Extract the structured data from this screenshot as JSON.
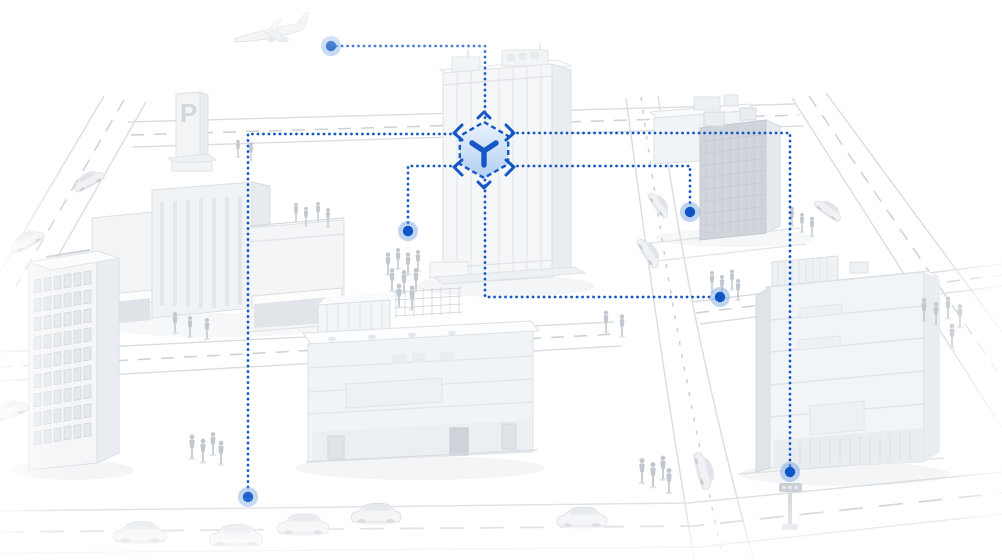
{
  "colors": {
    "accent_blue": "#1356c4",
    "dot_core": "#0d55c5",
    "dot_halo": "#6f9fe0",
    "hex_fill_top": "#e9f2fd",
    "hex_fill_bottom": "#b3cff2",
    "building_gray": "#f2f5f7",
    "road_gray": "#d9dde1"
  },
  "parking_sign": {
    "label": "P"
  },
  "icons": [
    "cube-3d-icon",
    "node-dot-icon",
    "airplane-icon",
    "parking-sign",
    "traffic-light-icon"
  ],
  "network": {
    "hub": {
      "x": 484,
      "y": 150,
      "radius": 28
    },
    "nodes": [
      {
        "id": "node-airplane",
        "x": 331,
        "y": 46
      },
      {
        "id": "node-plaza",
        "x": 408,
        "y": 231
      },
      {
        "id": "node-northeast-block",
        "x": 690,
        "y": 212
      },
      {
        "id": "node-crossing",
        "x": 720,
        "y": 297
      },
      {
        "id": "node-southwest-street",
        "x": 248,
        "y": 497
      },
      {
        "id": "node-southeast-street",
        "x": 790,
        "y": 472
      }
    ],
    "links": [
      {
        "id": "link-airplane",
        "points": [
          [
            331,
            46
          ],
          [
            485,
            46
          ],
          [
            485,
            121
          ]
        ]
      },
      {
        "id": "link-crossing",
        "points": [
          [
            485,
            180
          ],
          [
            485,
            297
          ],
          [
            714,
            297
          ]
        ]
      },
      {
        "id": "link-southwest",
        "points": [
          [
            456,
            134
          ],
          [
            248,
            134
          ],
          [
            248,
            491
          ]
        ]
      },
      {
        "id": "link-southeast",
        "points": [
          [
            512,
            133
          ],
          [
            790,
            133
          ],
          [
            790,
            466
          ]
        ]
      },
      {
        "id": "link-plaza",
        "points": [
          [
            456,
            166
          ],
          [
            408,
            166
          ],
          [
            408,
            225
          ]
        ]
      },
      {
        "id": "link-northeast",
        "points": [
          [
            512,
            166
          ],
          [
            690,
            166
          ],
          [
            690,
            206
          ]
        ]
      }
    ]
  }
}
